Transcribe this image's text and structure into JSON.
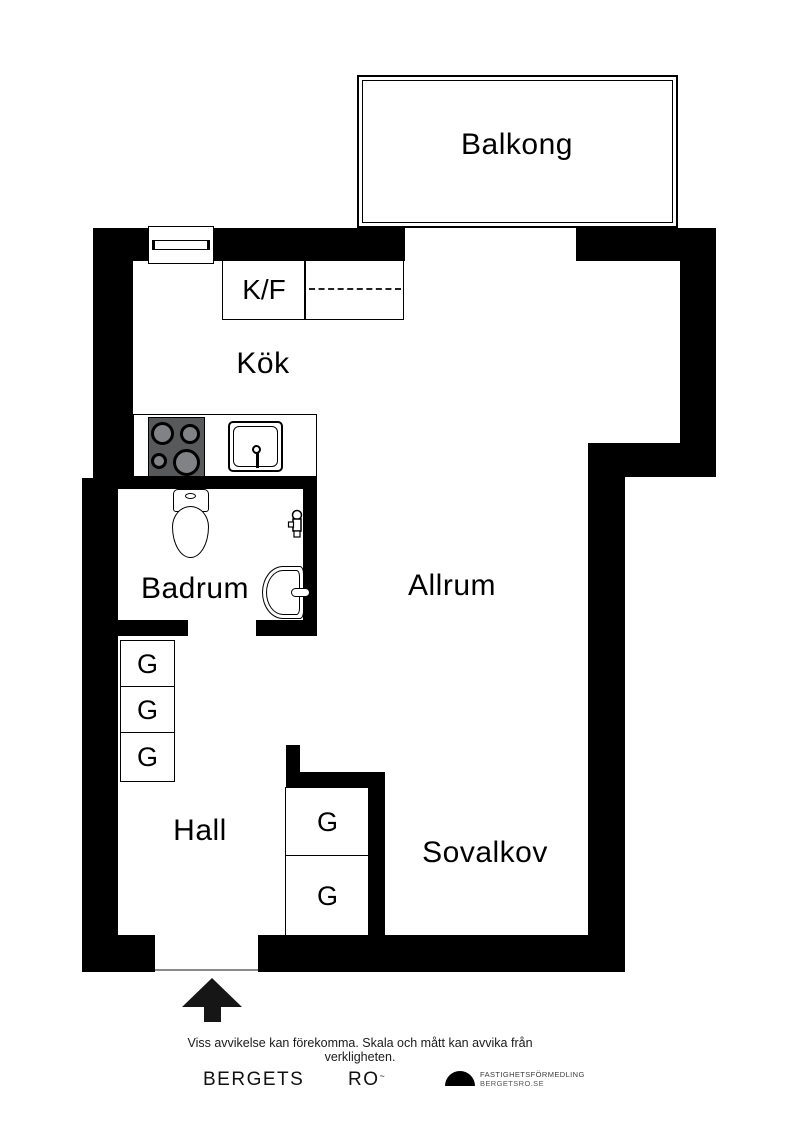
{
  "rooms": {
    "balcony": "Balkong",
    "kitchen": "Kök",
    "fridge_freezer": "K/F",
    "bathroom": "Badrum",
    "living_room": "Allrum",
    "hall": "Hall",
    "sleeping_alcove": "Sovalkov"
  },
  "wardrobes": {
    "left": [
      "G",
      "G",
      "G"
    ],
    "alcove": [
      "G",
      "G"
    ]
  },
  "footer": {
    "disclaimer": "Viss avvikelse kan förekomma. Skala och mått kan avvika från verkligheten.",
    "brand_word1": "BERGETS",
    "brand_word2": "RO",
    "brand_mark": "~",
    "logo_line1": "FASTIGHETSFÖRMEDLING",
    "logo_line2": "BERGETSRO.SE"
  },
  "colors": {
    "wall": "#000000",
    "background": "#ffffff",
    "stove_body": "#58595b",
    "burner_center": "#808285",
    "entrance_arrow": "#161616"
  }
}
